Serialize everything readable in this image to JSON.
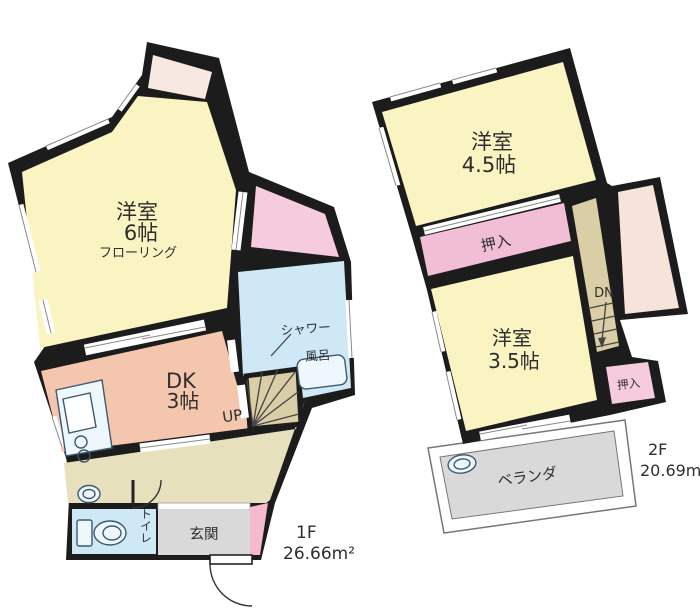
{
  "title": "floor-plan",
  "floor1": {
    "floor_label": "1F",
    "area": "26.66m²",
    "main_room": "洋室",
    "main_room_size": "6帖",
    "main_room_floor": "フローリング",
    "dk": "DK",
    "dk_size": "3帖",
    "stairs_up": "UP",
    "shower": "シャワー",
    "bath": "風呂",
    "toilet": "トイレ",
    "entrance": "玄関"
  },
  "floor2": {
    "floor_label": "2F",
    "area": "20.69m²",
    "room_top": "洋室",
    "room_top_size": "4.5帖",
    "closet": "押入",
    "stairs_down": "DN",
    "room_bottom": "洋室",
    "room_bottom_size": "3.5帖",
    "closet_small": "押入",
    "veranda": "ベランダ"
  },
  "colors": {
    "wall": "#1c1c1c",
    "room_yellow": "#FAF3C2",
    "dk_salmon": "#F5C6AE",
    "closet_pink": "#F2BED6",
    "closet_pale": "#F8E8E2",
    "water_blue": "#CEE8F5",
    "hall_beige": "#E7E0BD",
    "stair_tan": "#D9CEA6",
    "entrance_gray": "#D9D9D9",
    "veranda_gray": "#D9D9D9"
  }
}
